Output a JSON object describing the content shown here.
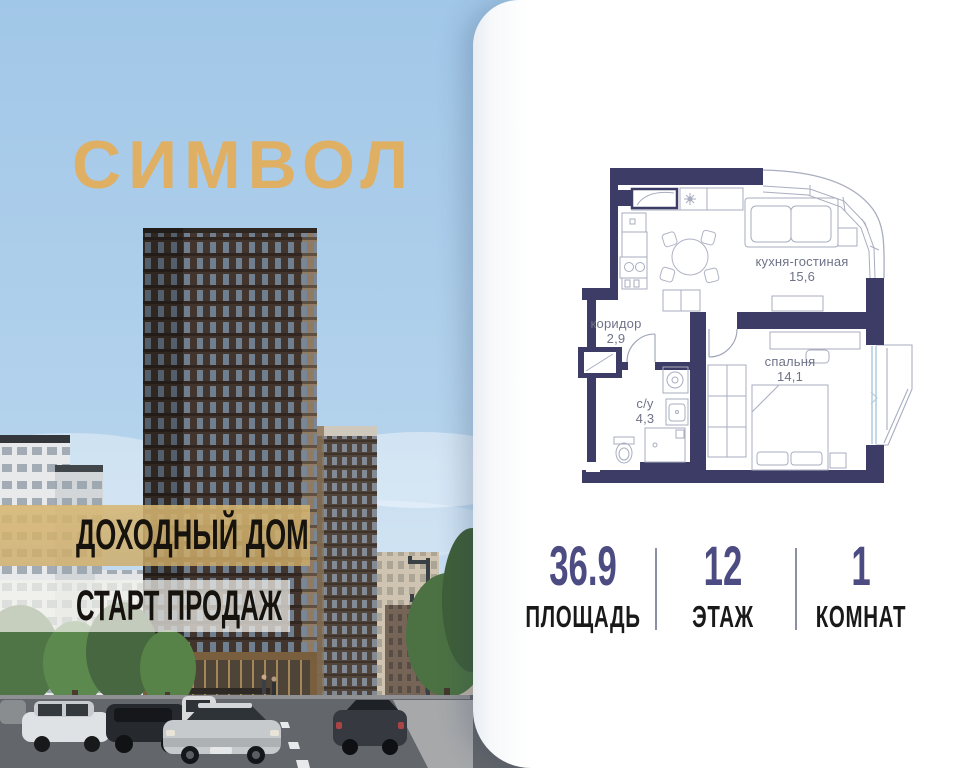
{
  "brand": {
    "name": "СИМВОЛ"
  },
  "banners": {
    "line1": "ДОХОДНЫЙ ДОМ",
    "line2": "СТАРТ ПРОДАЖ"
  },
  "floor_plan": {
    "rooms": [
      {
        "name": "кухня-гостиная",
        "area": "15,6"
      },
      {
        "name": "коридор",
        "area": "2,9"
      },
      {
        "name": "с/у",
        "area": "4,3"
      },
      {
        "name": "спальня",
        "area": "14,1"
      }
    ]
  },
  "stats": {
    "area": {
      "value": "36.9",
      "label": "ПЛОЩАДЬ"
    },
    "floor": {
      "value": "12",
      "label": "ЭТАЖ"
    },
    "rooms": {
      "value": "1",
      "label": "КОМНАТ"
    }
  },
  "colors": {
    "logo_gold": "#DFAF63",
    "wall_navy": "#3C3C66",
    "stat_indigo": "#4C4B82",
    "sky_blue": "#A2C8E8"
  }
}
